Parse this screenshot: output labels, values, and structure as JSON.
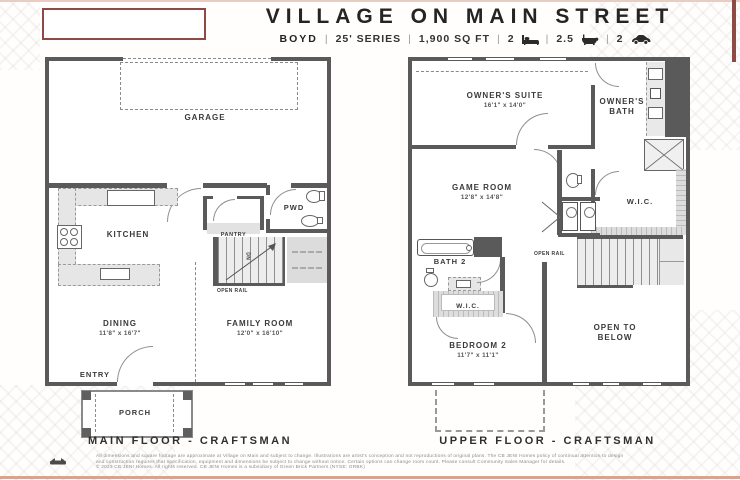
{
  "header": {
    "title": "VILLAGE ON MAIN STREET",
    "plan_name": "BOYD",
    "sep": "|",
    "series": "25' SERIES",
    "sqft": "1,900 SQ FT",
    "beds": "2",
    "baths": "2.5",
    "cars": "2"
  },
  "main_floor": {
    "caption": "MAIN FLOOR - CRAFTSMAN",
    "garage": "GARAGE",
    "kitchen": "KITCHEN",
    "pantry": "PANTRY",
    "pwd": "PWD",
    "dining_name": "DINING",
    "dining_dims": "11'8\" x 16'7\"",
    "family_name": "FAMILY ROOM",
    "family_dims": "12'0\" x 16'10\"",
    "entry": "ENTRY",
    "porch": "PORCH",
    "open_rail": "OPEN RAIL",
    "stairs_dn": "DN"
  },
  "upper_floor": {
    "caption": "UPPER FLOOR - CRAFTSMAN",
    "owners_suite_name": "OWNER'S SUITE",
    "owners_suite_dims": "16'1\" x 14'0\"",
    "owners_bath": "OWNER'S BATH",
    "game_room_name": "GAME ROOM",
    "game_room_dims": "12'8\" x 14'8\"",
    "wic_owners": "W.I.C.",
    "bath2": "BATH 2",
    "wic2": "W.I.C.",
    "bedroom2_name": "BEDROOM 2",
    "bedroom2_dims": "11'7\" x 11'1\"",
    "open_to_below": "OPEN TO BELOW",
    "open_rail": "OPEN RAIL"
  },
  "footer": {
    "line1": "All dimensions and square footage are approximate at Village on Main and subject to change. Illustrations are artist's conception and not reproductions of original plans. The CB JENI Homes policy of continual attention to design",
    "line2": "and construction requires that specification, equipment and dimensions be subject to change without notice. Certain options can change room count. Please consult Community Sales Manager for details.",
    "line3": "© 2023 CB JENI Homes. All rights reserved. CB JENI Homes is a subsidiary of Green Brick Partners (NYSE: GRBK)"
  },
  "colors": {
    "wall": "#5a5a5a",
    "accent_maroon": "#8e4a44",
    "accent_salmon": "#e0a287"
  }
}
